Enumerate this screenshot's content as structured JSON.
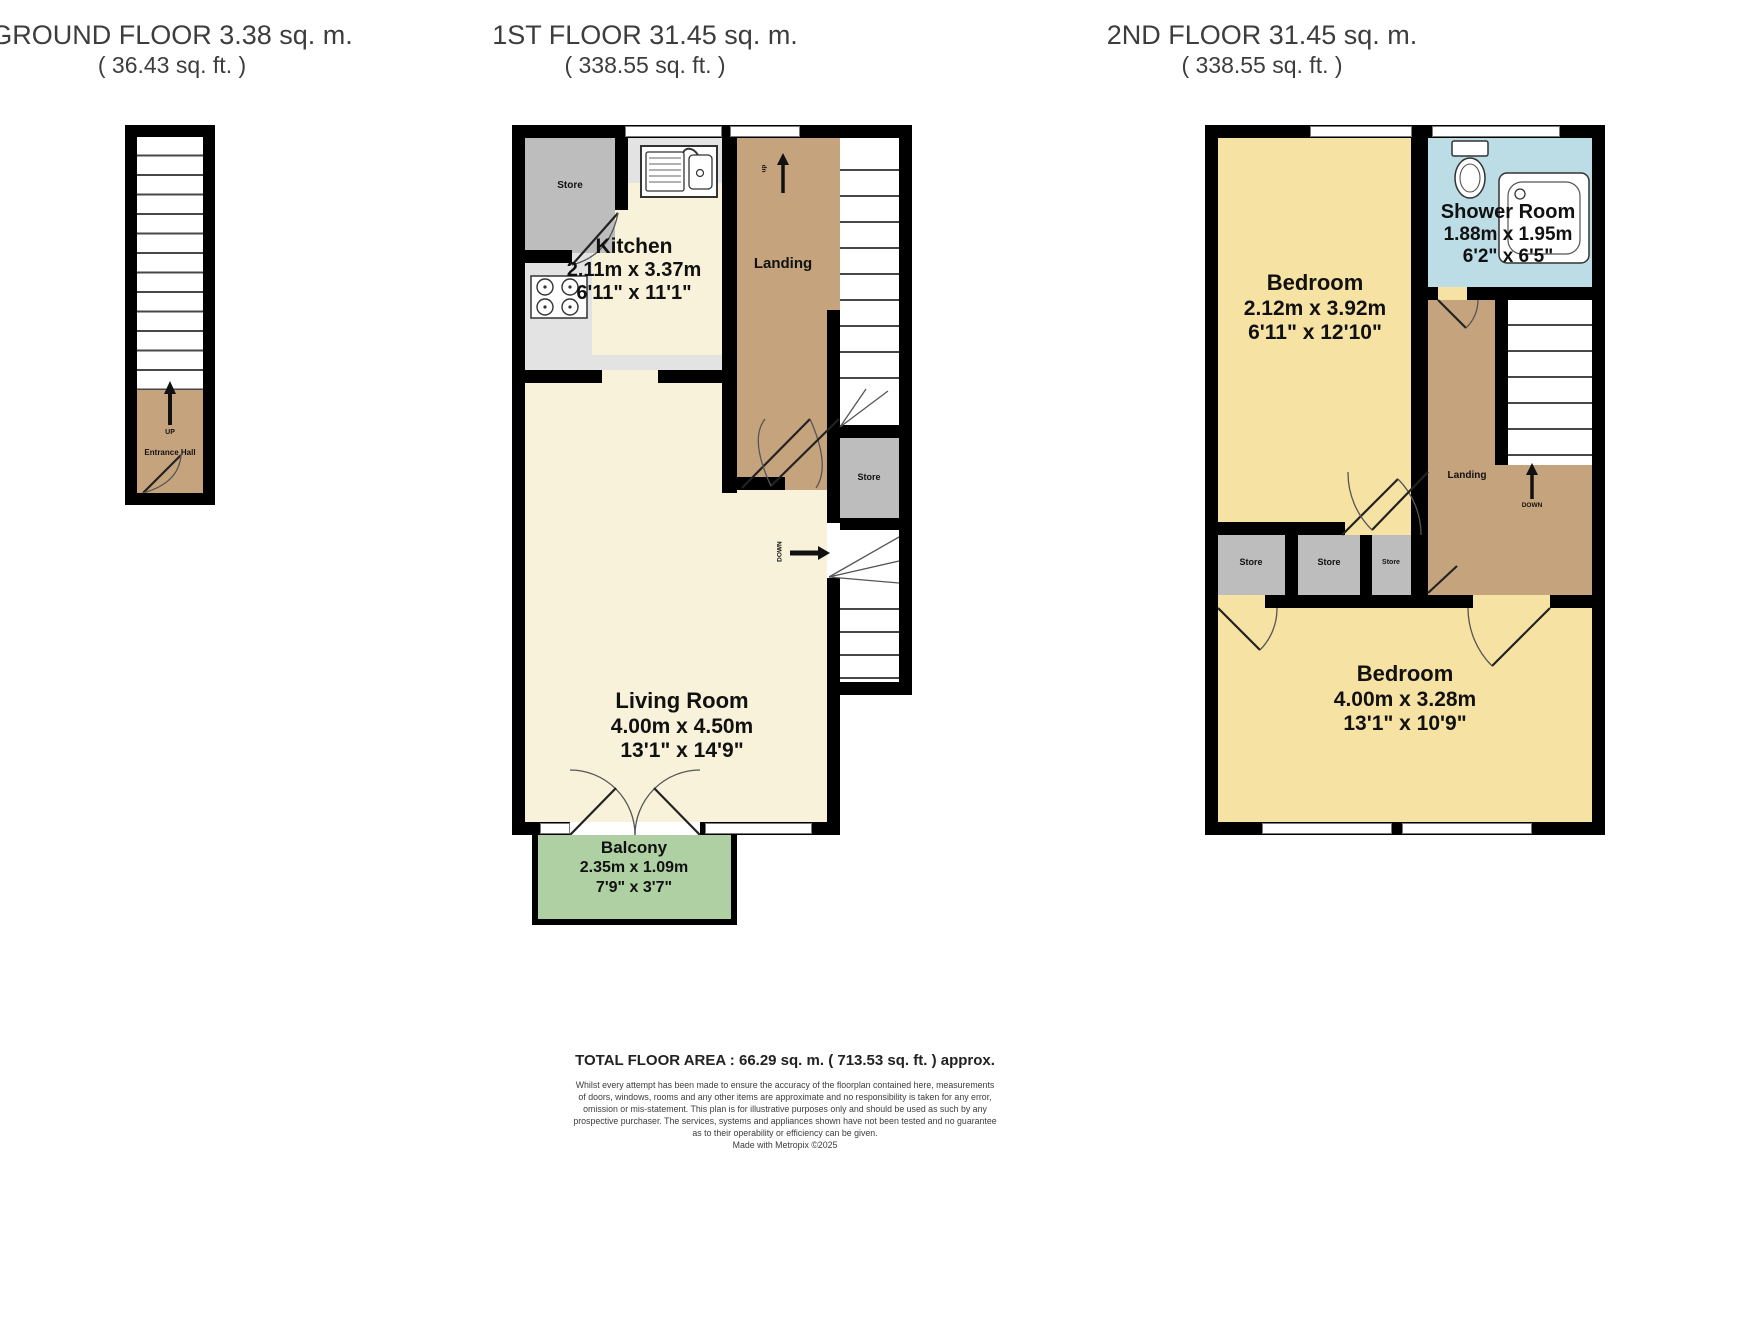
{
  "colors": {
    "wall": "#000000",
    "hall_tan": "#c5a37d",
    "cream": "#f7f2d9",
    "kitchen_gray": "#e3e3e3",
    "store_gray": "#bdbdbd",
    "bedroom_yellow": "#f6e2a2",
    "shower_blue": "#bcdce6",
    "balcony_green": "#afd0a3",
    "title_text": "#3d3d3d",
    "label_text": "#111111"
  },
  "titles": {
    "ground": {
      "line1": "GROUND FLOOR 3.38 sq. m.",
      "line2": "( 36.43 sq. ft. )"
    },
    "first": {
      "line1": "1ST FLOOR 31.45 sq. m.",
      "line2": "( 338.55 sq. ft. )"
    },
    "second": {
      "line1": "2ND FLOOR 31.45 sq. m.",
      "line2": "( 338.55 sq. ft. )"
    }
  },
  "ground_floor": {
    "up_label": "UP",
    "hall_label": "Entrance Hall"
  },
  "first_floor": {
    "kitchen_store_label": "Store",
    "kitchen": {
      "name": "Kitchen",
      "metric": "2.11m x 3.37m",
      "imperial": "6'11\" x 11'1\""
    },
    "landing_label": "Landing",
    "stair_up_label": "up",
    "stair_store_label": "Store",
    "stair_down_label": "DOWN",
    "living_room": {
      "name": "Living Room",
      "metric": "4.00m x 4.50m",
      "imperial": "13'1\" x 14'9\""
    },
    "balcony": {
      "name": "Balcony",
      "metric": "2.35m x 1.09m",
      "imperial": "7'9\" x 3'7\""
    }
  },
  "second_floor": {
    "bedroom_small": {
      "name": "Bedroom",
      "metric": "2.12m x 3.92m",
      "imperial": "6'11\" x 12'10\""
    },
    "shower_room": {
      "name": "Shower Room",
      "metric": "1.88m x 1.95m",
      "imperial": "6'2\" x 6'5\""
    },
    "landing_label": "Landing",
    "stair_down_label": "DOWN",
    "store1_label": "Store",
    "store2_label": "Store",
    "store3_label": "Store",
    "bedroom_large": {
      "name": "Bedroom",
      "metric": "4.00m x 3.28m",
      "imperial": "13'1\" x 10'9\""
    }
  },
  "footer": {
    "total_area": "TOTAL FLOOR AREA : 66.29 sq. m. ( 713.53 sq. ft. ) approx.",
    "disclaimer": [
      "Whilst every attempt has been made to ensure the accuracy of the floorplan contained here, measurements",
      "of doors, windows, rooms and any other items are approximate and no responsibility is taken for any error,",
      "omission or mis-statement. This plan is for illustrative purposes only and should be used as such by any",
      "prospective purchaser. The services, systems and appliances shown have not been tested and no guarantee",
      "as to their operability or efficiency can be given.",
      "Made with Metropix ©2025"
    ]
  },
  "icons": {
    "sink": "kitchen-sink-icon",
    "stove": "stove-hob-icon",
    "toilet": "toilet-icon",
    "shower_tray": "shower-tray-icon",
    "up_arrow": "up-arrow-icon",
    "down_arrow": "down-arrow-icon"
  }
}
